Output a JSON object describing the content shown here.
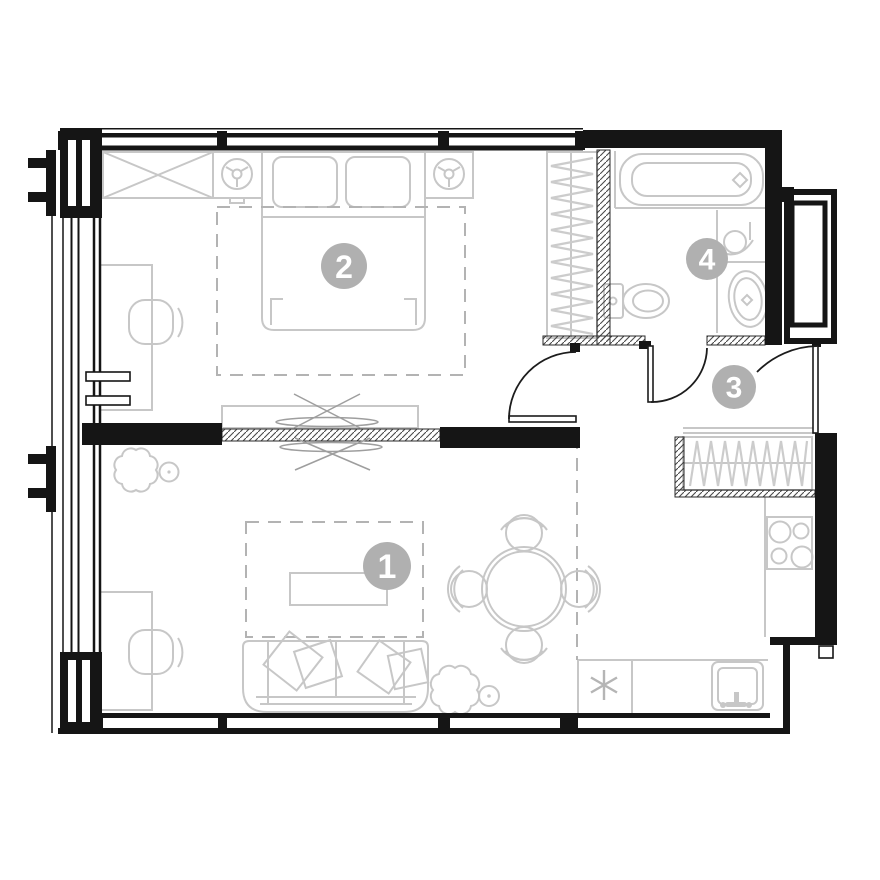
{
  "plan": {
    "title": "apartment floor plan",
    "background": "#ffffff",
    "colors": {
      "walls": "#151515",
      "furniture": "#c7c7c7",
      "dashed": "#b3b3b3",
      "badge_fill": "#b0b0b0",
      "badge_text": "#ffffff"
    },
    "rooms": [
      {
        "label": "1",
        "name": "living-room-kitchen"
      },
      {
        "label": "2",
        "name": "bedroom"
      },
      {
        "label": "3",
        "name": "hallway"
      },
      {
        "label": "4",
        "name": "bathroom"
      }
    ],
    "symbols": {
      "kitchen_asterisk": "six-spoke-asterisk"
    }
  }
}
